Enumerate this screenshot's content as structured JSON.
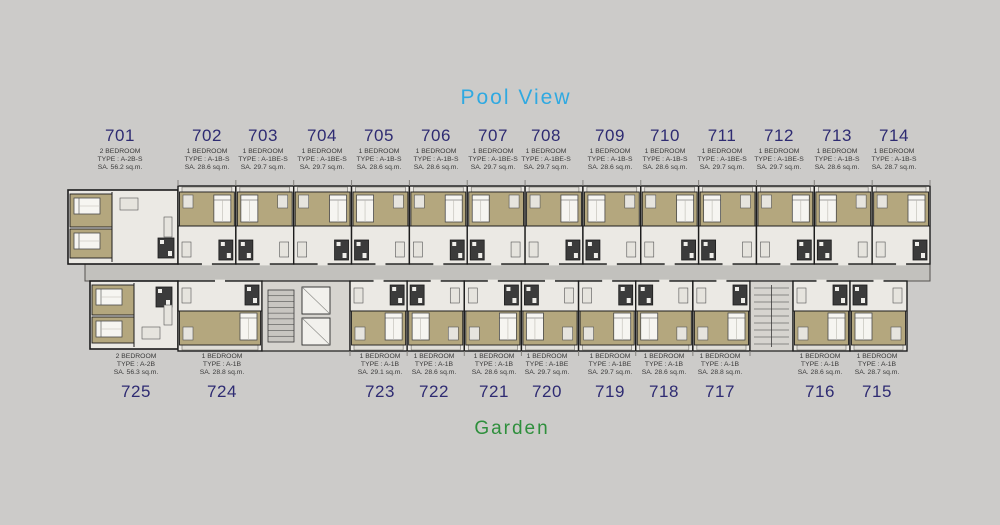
{
  "scene": {
    "background": "#cccbc9",
    "pool_view": {
      "text": "Pool View",
      "color": "#2fa9e1"
    },
    "garden": {
      "text": "Garden",
      "color": "#2e8f3c"
    }
  },
  "colors": {
    "unit_number": "#2e2b72",
    "unit_info": "#3a3a3a",
    "wall": "#1c1c1c",
    "floor": "#ebe9e4",
    "balcony": "#e0ded8",
    "bedroom_carpet": "#b4a77e",
    "bathroom": "#3b3b3b",
    "corridor": "#c2c1bd",
    "core": "#d6d4cf",
    "bed": "#f6f5f1"
  },
  "units_top": [
    {
      "no": "701",
      "bedrooms": "2 BEDROOM",
      "type": "TYPE : A-2B-S",
      "area": "SA. 56.2 sq.m.",
      "cx": 120
    },
    {
      "no": "702",
      "bedrooms": "1 BEDROOM",
      "type": "TYPE : A-1B-S",
      "area": "SA. 28.6 sq.m.",
      "cx": 207
    },
    {
      "no": "703",
      "bedrooms": "1 BEDROOM",
      "type": "TYPE : A-1BE-S",
      "area": "SA. 29.7 sq.m.",
      "cx": 263
    },
    {
      "no": "704",
      "bedrooms": "1 BEDROOM",
      "type": "TYPE : A-1BE-S",
      "area": "SA. 29.7 sq.m.",
      "cx": 322
    },
    {
      "no": "705",
      "bedrooms": "1 BEDROOM",
      "type": "TYPE : A-1B-S",
      "area": "SA. 28.6 sq.m.",
      "cx": 379
    },
    {
      "no": "706",
      "bedrooms": "1 BEDROOM",
      "type": "TYPE : A-1B-S",
      "area": "SA. 28.6 sq.m.",
      "cx": 436
    },
    {
      "no": "707",
      "bedrooms": "1 BEDROOM",
      "type": "TYPE : A-1BE-S",
      "area": "SA. 29.7 sq.m.",
      "cx": 493
    },
    {
      "no": "708",
      "bedrooms": "1 BEDROOM",
      "type": "TYPE : A-1BE-S",
      "area": "SA. 29.7 sq.m.",
      "cx": 546
    },
    {
      "no": "709",
      "bedrooms": "1 BEDROOM",
      "type": "TYPE : A-1B-S",
      "area": "SA. 28.6 sq.m.",
      "cx": 610
    },
    {
      "no": "710",
      "bedrooms": "1 BEDROOM",
      "type": "TYPE : A-1B-S",
      "area": "SA. 28.6 sq.m.",
      "cx": 665
    },
    {
      "no": "711",
      "bedrooms": "1 BEDROOM",
      "type": "TYPE : A-1BE-S",
      "area": "SA. 29.7 sq.m.",
      "cx": 722
    },
    {
      "no": "712",
      "bedrooms": "1 BEDROOM",
      "type": "TYPE : A-1BE-S",
      "area": "SA. 29.7 sq.m.",
      "cx": 779
    },
    {
      "no": "713",
      "bedrooms": "1 BEDROOM",
      "type": "TYPE : A-1B-S",
      "area": "SA. 28.6 sq.m.",
      "cx": 837
    },
    {
      "no": "714",
      "bedrooms": "1 BEDROOM",
      "type": "TYPE : A-1B-S",
      "area": "SA. 28.7 sq.m.",
      "cx": 894
    }
  ],
  "units_bottom": [
    {
      "no": "725",
      "bedrooms": "2 BEDROOM",
      "type": "TYPE : A-2B",
      "area": "SA. 56.3 sq.m.",
      "cx": 136
    },
    {
      "no": "724",
      "bedrooms": "1 BEDROOM",
      "type": "TYPE : A-1B",
      "area": "SA. 28.8 sq.m.",
      "cx": 222
    },
    {
      "no": "723",
      "bedrooms": "1 BEDROOM",
      "type": "TYPE : A-1B",
      "area": "SA. 29.1 sq.m.",
      "cx": 380
    },
    {
      "no": "722",
      "bedrooms": "1 BEDROOM",
      "type": "TYPE : A-1B",
      "area": "SA. 28.6 sq.m.",
      "cx": 434
    },
    {
      "no": "721",
      "bedrooms": "1 BEDROOM",
      "type": "TYPE : A-1B",
      "area": "SA. 28.6 sq.m.",
      "cx": 494
    },
    {
      "no": "720",
      "bedrooms": "1 BEDROOM",
      "type": "TYPE : A-1BE",
      "area": "SA. 29.7 sq.m.",
      "cx": 547
    },
    {
      "no": "719",
      "bedrooms": "1 BEDROOM",
      "type": "TYPE : A-1BE",
      "area": "SA. 29.7 sq.m.",
      "cx": 610
    },
    {
      "no": "718",
      "bedrooms": "1 BEDROOM",
      "type": "TYPE : A-1B",
      "area": "SA. 28.6 sq.m.",
      "cx": 664
    },
    {
      "no": "717",
      "bedrooms": "1 BEDROOM",
      "type": "TYPE : A-1B",
      "area": "SA. 28.8 sq.m.",
      "cx": 720
    },
    {
      "no": "716",
      "bedrooms": "1 BEDROOM",
      "type": "TYPE : A-1B",
      "area": "SA. 28.6 sq.m.",
      "cx": 820
    },
    {
      "no": "715",
      "bedrooms": "1 BEDROOM",
      "type": "TYPE : A-1B",
      "area": "SA. 28.7 sq.m.",
      "cx": 877
    }
  ]
}
